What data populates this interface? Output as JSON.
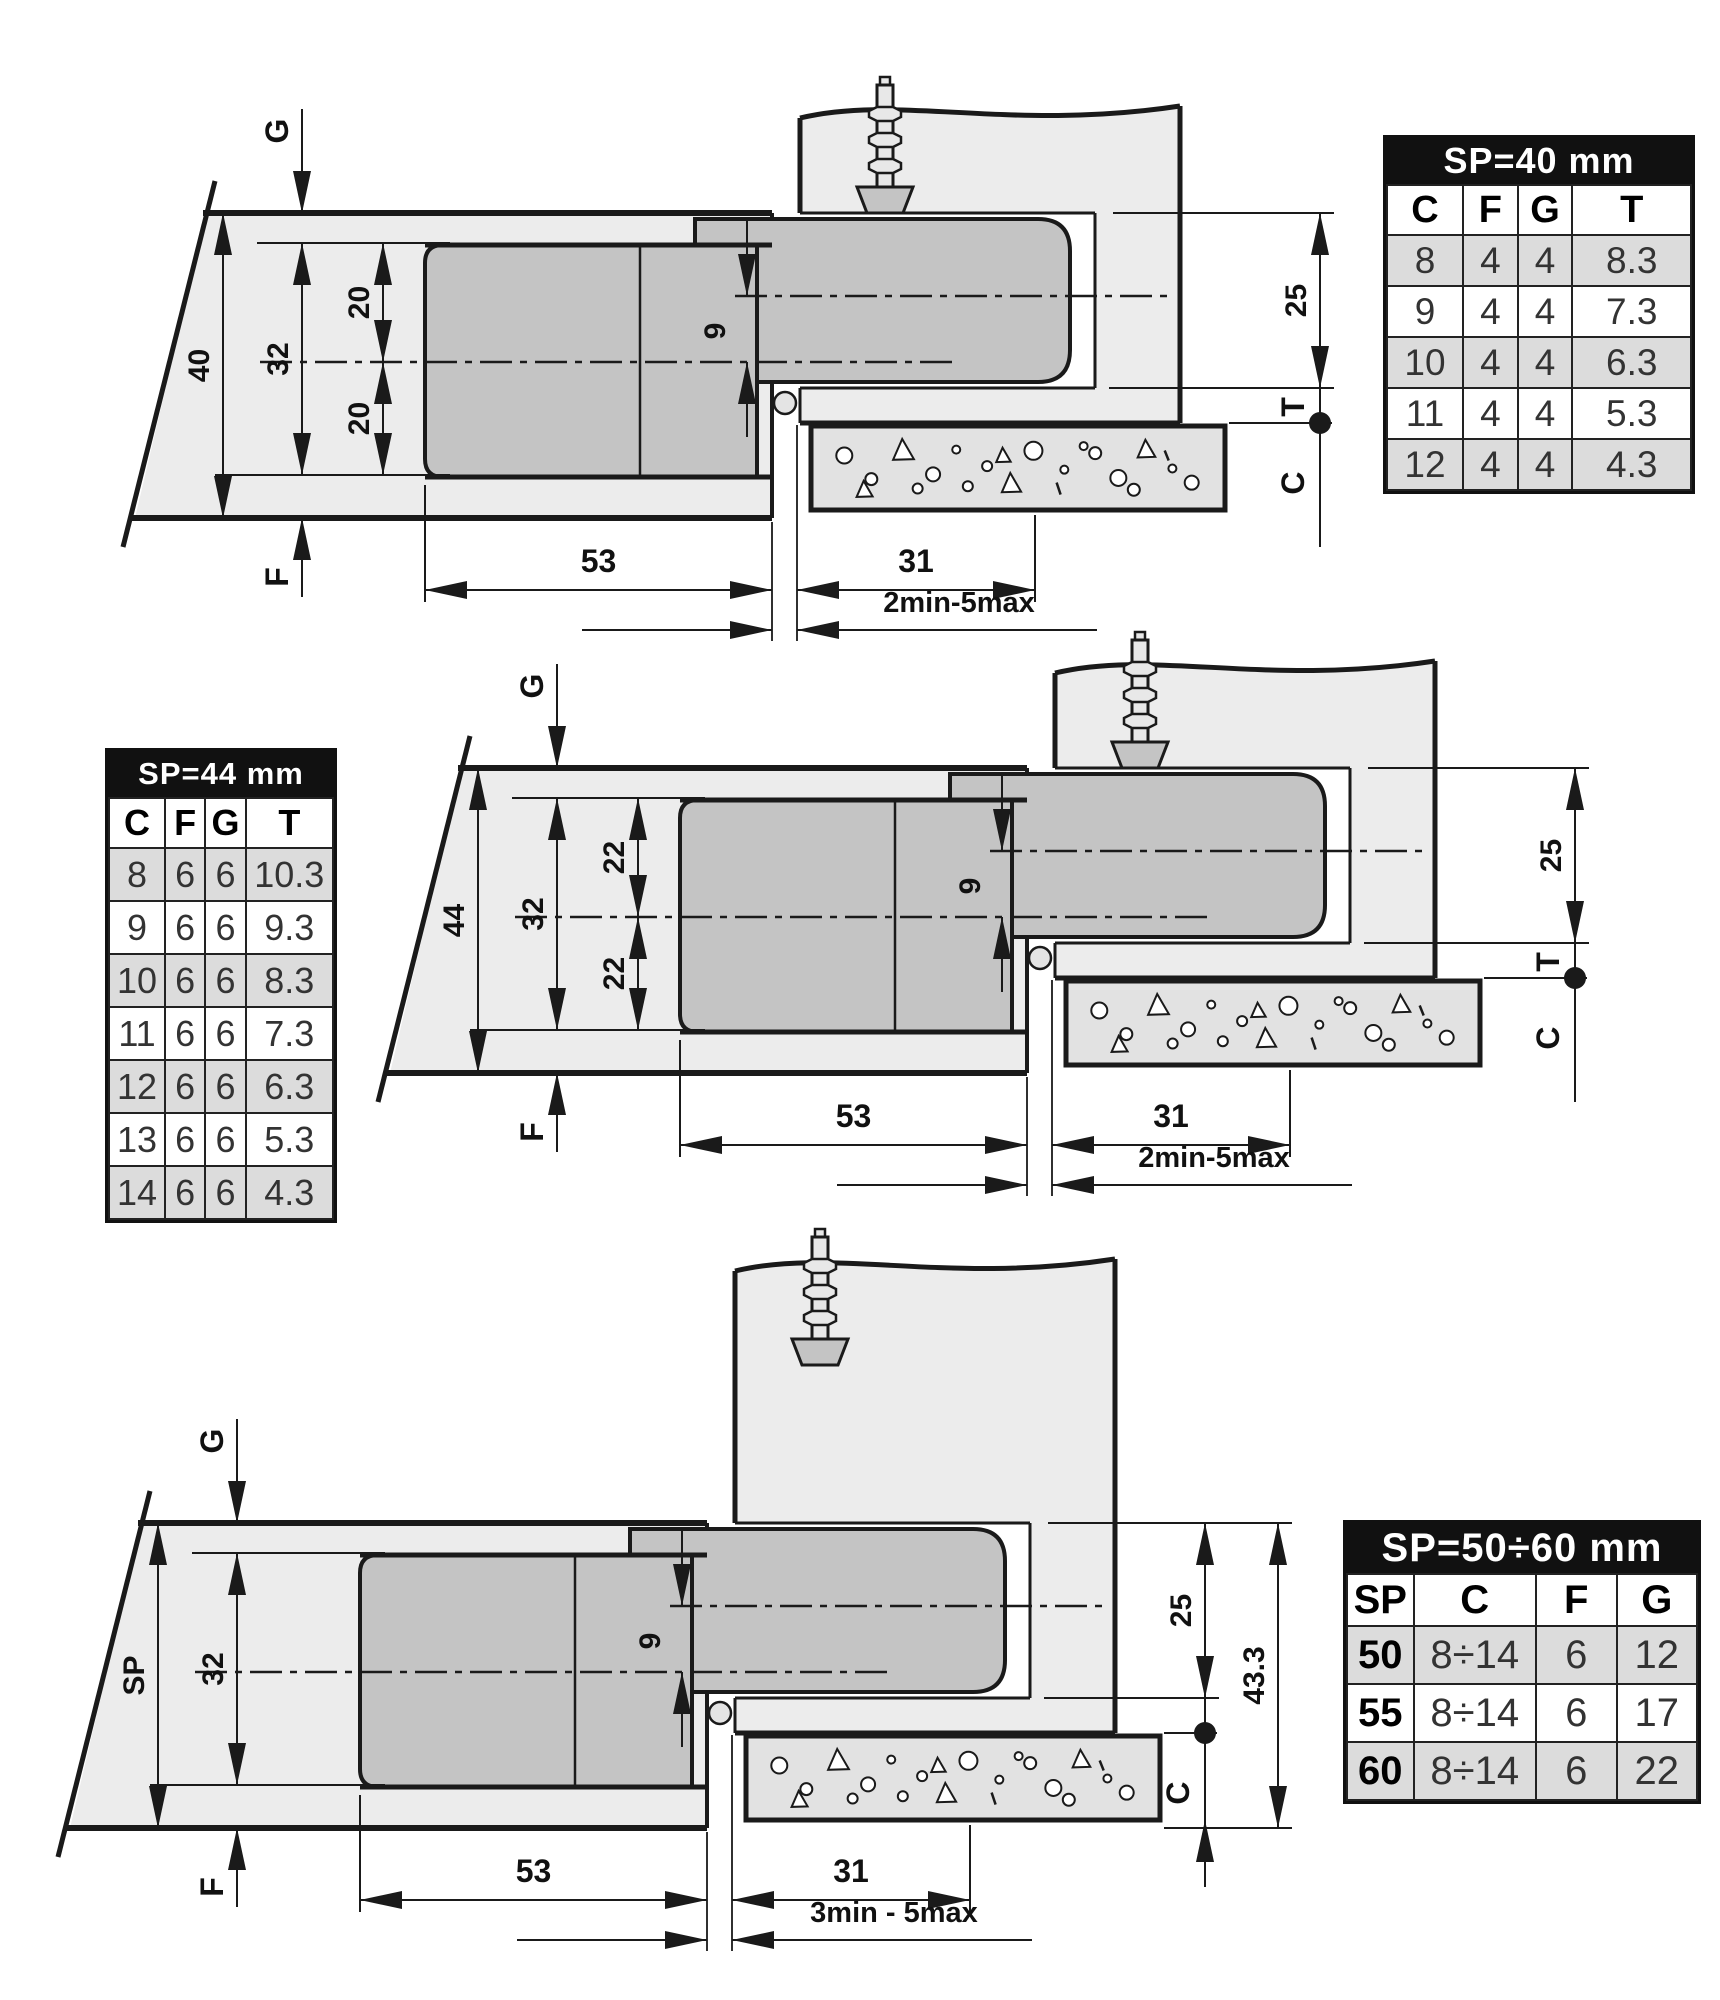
{
  "drawings": [
    {
      "id": "d1",
      "labels": {
        "g": "G",
        "f": "F",
        "t": "T",
        "c": "C",
        "thickness": "40",
        "axis": "32",
        "offset_top": "20",
        "offset_bottom": "20",
        "cup_axis": "9",
        "recess": "25",
        "cup_depth": "53",
        "arm": "31",
        "gap": "2min-5max"
      }
    },
    {
      "id": "d2",
      "labels": {
        "g": "G",
        "f": "F",
        "t": "T",
        "c": "C",
        "thickness": "44",
        "axis": "32",
        "offset_top": "22",
        "offset_bottom": "22",
        "cup_axis": "9",
        "recess": "25",
        "cup_depth": "53",
        "arm": "31",
        "gap": "2min-5max"
      }
    },
    {
      "id": "d3",
      "labels": {
        "g": "G",
        "f": "F",
        "c": "C",
        "thickness": "SP",
        "axis": "32",
        "cup_axis": "9",
        "recess": "25",
        "total": "43.3",
        "cup_depth": "53",
        "arm": "31",
        "gap": "3min - 5max"
      }
    }
  ],
  "tables": [
    {
      "id": "sp40",
      "title": "SP=40 mm",
      "columns": [
        "C",
        "F",
        "G",
        "T"
      ],
      "rows": [
        [
          "8",
          "4",
          "4",
          "8.3"
        ],
        [
          "9",
          "4",
          "4",
          "7.3"
        ],
        [
          "10",
          "4",
          "4",
          "6.3"
        ],
        [
          "11",
          "4",
          "4",
          "5.3"
        ],
        [
          "12",
          "4",
          "4",
          "4.3"
        ]
      ]
    },
    {
      "id": "sp44",
      "title": "SP=44 mm",
      "columns": [
        "C",
        "F",
        "G",
        "T"
      ],
      "rows": [
        [
          "8",
          "6",
          "6",
          "10.3"
        ],
        [
          "9",
          "6",
          "6",
          "9.3"
        ],
        [
          "10",
          "6",
          "6",
          "8.3"
        ],
        [
          "11",
          "6",
          "6",
          "7.3"
        ],
        [
          "12",
          "6",
          "6",
          "6.3"
        ],
        [
          "13",
          "6",
          "6",
          "5.3"
        ],
        [
          "14",
          "6",
          "6",
          "4.3"
        ]
      ]
    },
    {
      "id": "sp5060",
      "title": "SP=50÷60 mm",
      "columns": [
        "SP",
        "C",
        "F",
        "G"
      ],
      "rows": [
        [
          "50",
          "8÷14",
          "6",
          "12"
        ],
        [
          "55",
          "8÷14",
          "6",
          "17"
        ],
        [
          "60",
          "8÷14",
          "6",
          "22"
        ]
      ],
      "first_col_bold": true
    }
  ],
  "colors": {
    "line": "#1a1a1a",
    "door_fill": "#ececec",
    "hinge_fill": "#c4c4c4",
    "wall_fill": "#e2e2e2",
    "knuckle_fill": "#e4e4e4",
    "table_row_alt": "#dcdcdc",
    "table_header_bg": "#111111",
    "table_header_text": "#ffffff"
  }
}
